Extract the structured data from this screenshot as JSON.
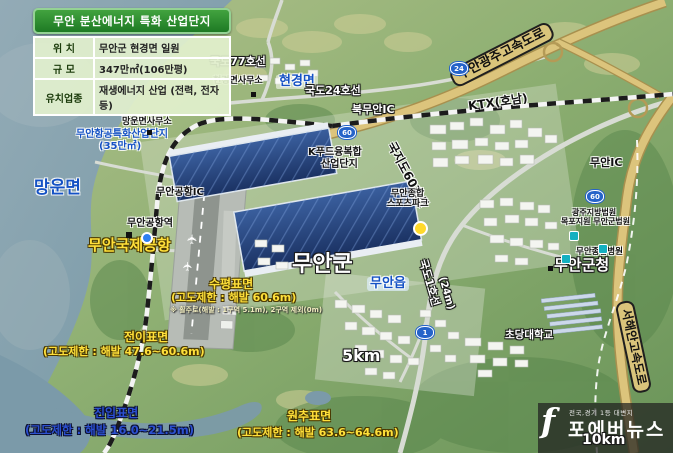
{
  "info_box": {
    "title": "무안 분산에너지 특화 산업단지",
    "rows": [
      {
        "label": "위 치",
        "value": "무안군 현경면 일원"
      },
      {
        "label": "규 모",
        "value": "347만㎡(106만평)"
      },
      {
        "label": "유치업종",
        "value": "재생에너지 산업 (전력, 전자 등)"
      }
    ]
  },
  "labels": {
    "road77": "국도77호선",
    "hyeongyeong_office": "현경면사무소",
    "hyeongyeong_myeon": "현경면",
    "road24": "국도24호선",
    "bukmuan_ic": "북무안IC",
    "muan_gwangju_expressway": "무안광주고속도로",
    "ktx_honam": "KTX(호남)",
    "mangun_office": "망운면사무소",
    "aviation_complex": "무안항공특화산업단지",
    "aviation_complex_size": "(35만㎡)",
    "mangun_myeon": "망운면",
    "muan_airport_ic": "무안공항IC",
    "muan_airport_station": "무안공항역",
    "muan_intl_airport": "무안국제공항",
    "kfood_complex_line1": "K푸드융복합",
    "kfood_complex_line2": "산업단지",
    "local_road60": "국지도60호선",
    "sports_park_line1": "무안종합",
    "sports_park_line2": "스포츠파크",
    "muan_ic": "무안IC",
    "court_line1": "광주지방법원",
    "court_line2": "목포지원 무안군법원",
    "hospital": "무안종합병원",
    "muan_county_office": "무안군청",
    "muan_gun": "무안군",
    "muan_eup": "무안읍",
    "road1": "국도1호선",
    "road1_width": "(24m)",
    "chodang_university": "초당대학교",
    "scale_5km": "5km",
    "scale_10km": "10km",
    "seohaean_expressway": "서해안고속도로"
  },
  "surfaces": {
    "horizontal": {
      "name": "수평표면",
      "limit": "(고도제한 : 해발 60.6m)",
      "note": "※ 활주로(해발 : 1구역 5.1m), 2구역 제외(0m)"
    },
    "transition": {
      "name": "전이표면",
      "limit": "(고도제한 : 해발 47.6~60.6m)"
    },
    "approach": {
      "name": "진입표면",
      "limit": "(고도제한 : 해발 16.0~21.5m)"
    },
    "conical": {
      "name": "원추표면",
      "limit": "(고도제한 : 해발 63.6~64.6m)"
    }
  },
  "route_shields": {
    "shield_24": "24",
    "shield_60a": "60",
    "shield_60b": "60",
    "shield_1": "1"
  },
  "watermark": {
    "logo": "f",
    "tagline": "전국,경기 1등 대변지",
    "brand": "포에버뉴스"
  },
  "colors": {
    "header_green": "#2a8a2e",
    "surface_yellow": "#ffe03a",
    "surface_blue": "#2b50d0",
    "map_label_blue": "#1552c4",
    "airport_yellow": "#ffdf2e",
    "expressway_tan": "#d9c47b",
    "solar_roof_blue": "#1b3263",
    "sea_blue": "#7496a4"
  }
}
